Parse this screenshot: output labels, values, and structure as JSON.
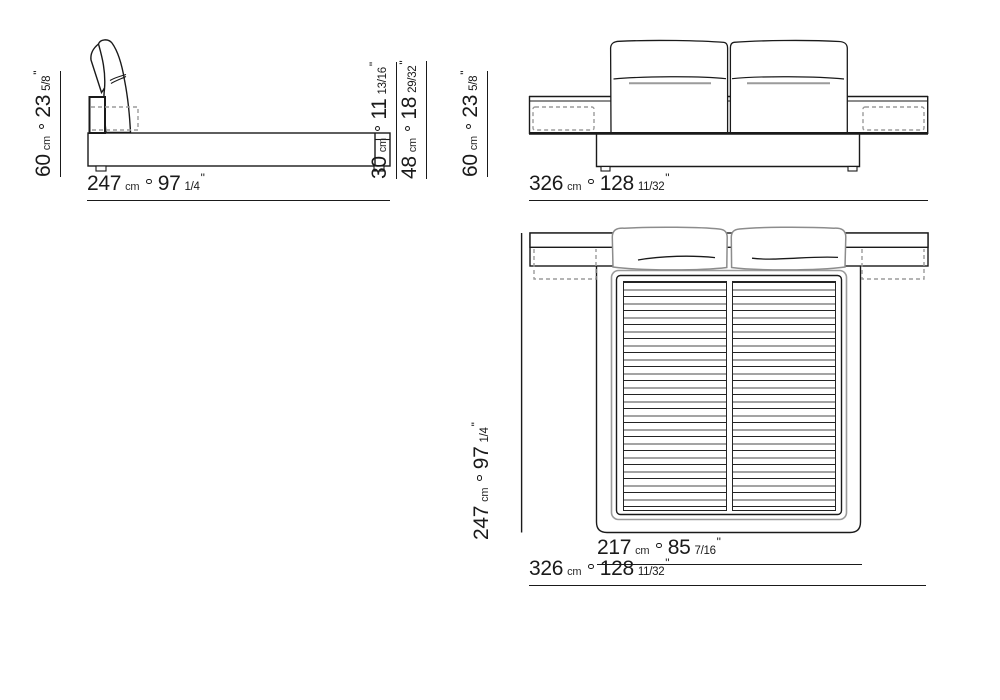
{
  "document": {
    "type": "furniture-dimension-drawing",
    "views": [
      "side-elevation",
      "front-elevation",
      "top-plan"
    ]
  },
  "units": {
    "metric": "cm",
    "inch_mark": "\""
  },
  "dimensions": {
    "side_width": {
      "cm": "247",
      "inches": "97",
      "fraction": "1/4"
    },
    "side_height": {
      "cm": "60",
      "inches": "23",
      "fraction": "5/8"
    },
    "side_platform_height": {
      "cm": "30",
      "inches": "11",
      "fraction": "13/16"
    },
    "side_footend_height": {
      "cm": "48",
      "inches": "18",
      "fraction": "29/32"
    },
    "front_width": {
      "cm": "326",
      "inches": "128",
      "fraction": "11/32"
    },
    "front_height": {
      "cm": "60",
      "inches": "23",
      "fraction": "5/8"
    },
    "top_depth": {
      "cm": "247",
      "inches": "97",
      "fraction": "1/4"
    },
    "top_mattress_width": {
      "cm": "217",
      "inches": "85",
      "fraction": "7/16"
    },
    "top_total_width": {
      "cm": "326",
      "inches": "128",
      "fraction": "11/32"
    }
  },
  "colors": {
    "line": "#1a1a1a",
    "grey_line": "#9b9b9b",
    "background": "#ffffff"
  }
}
